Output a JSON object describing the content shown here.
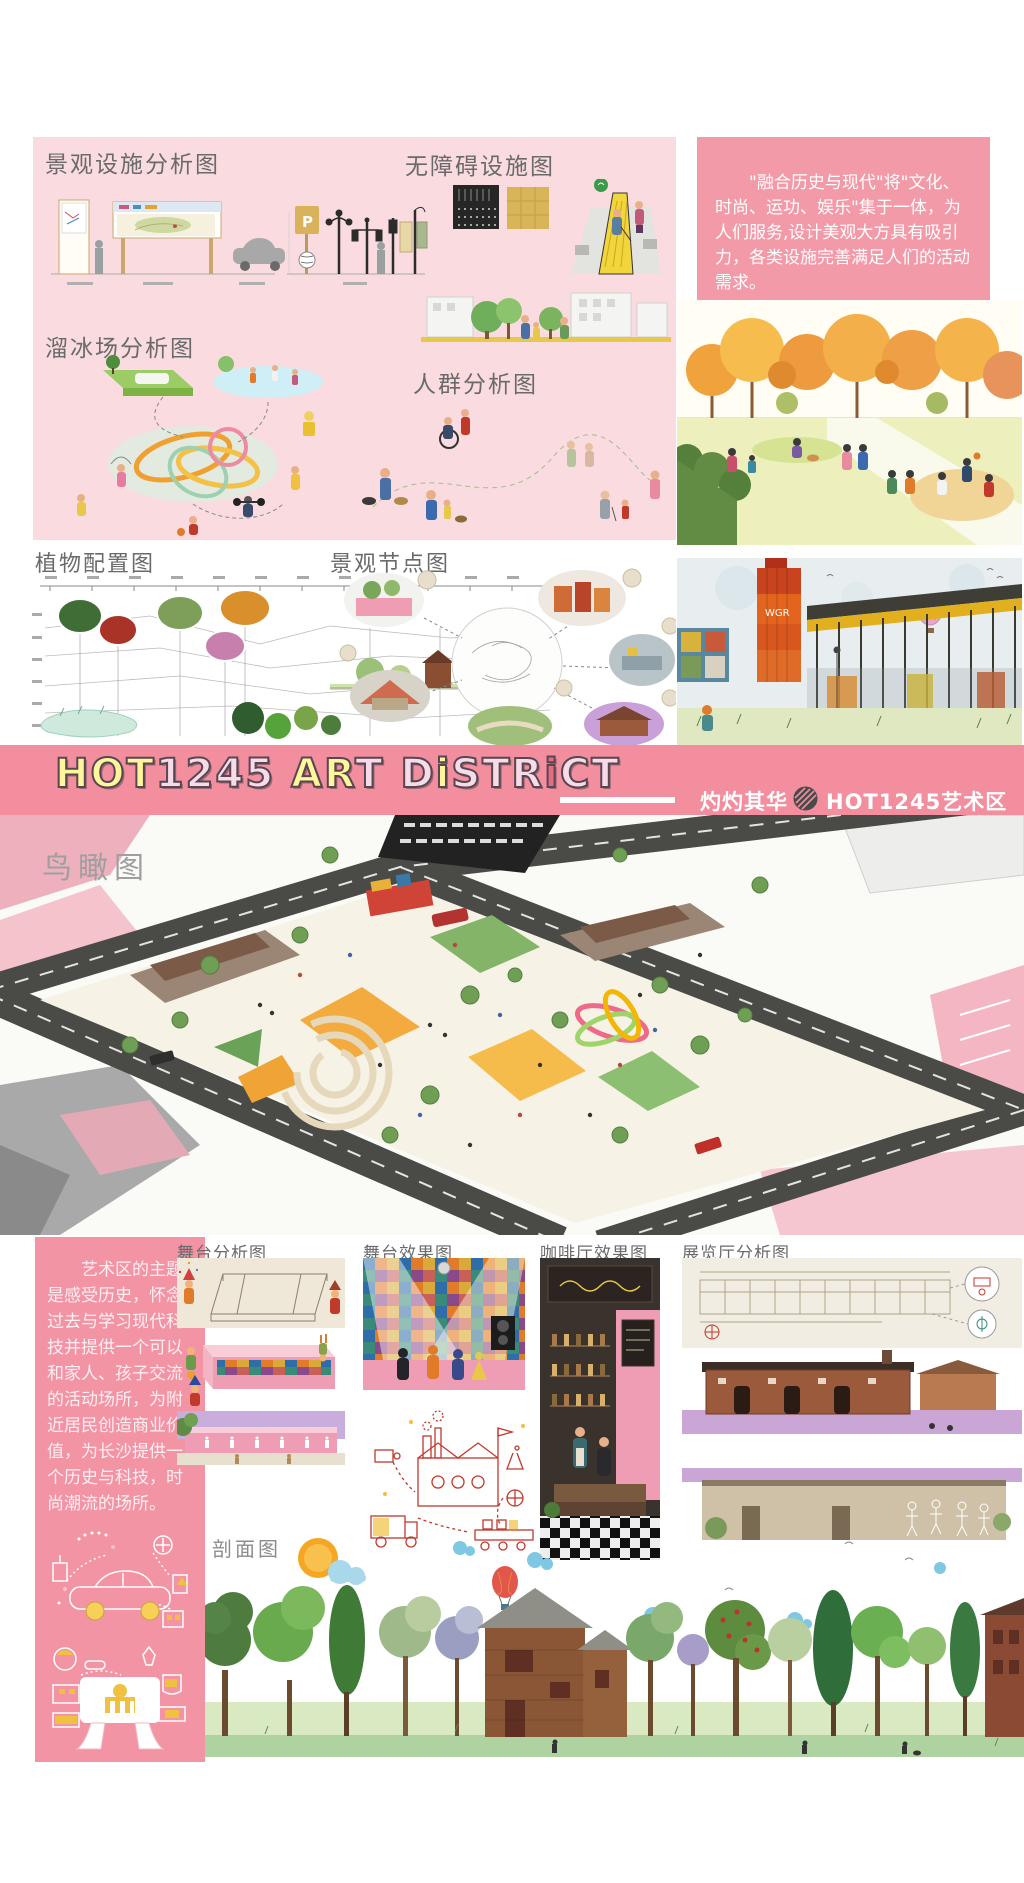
{
  "poster": {
    "width": 1024,
    "height": 1883
  },
  "colors": {
    "panel_pink": "#FADCE0",
    "intro_box_pink": "#F29AA8",
    "banner_pink": "#F28E9E",
    "sidebar_pink": "#F394A4",
    "title_gray": "#6A6A6A",
    "watermark_gray": "#9F9F9F",
    "letter_yellow": "#FFF59A",
    "letter_pale_pink": "#F8DBE8",
    "letter_accent_pink": "#E86A80"
  },
  "top_panel": {
    "landscape_facilities_title": "景观设施分析图",
    "barrier_free_title": "无障碍设施图",
    "ice_rink_title": "溜冰场分析图",
    "crowd_title": "人群分析图",
    "parking_sign_letter": "P",
    "intro_text": "\"融合历史与现代\"将\"文化、时尚、运功、娱乐\"集于一体，为人们服务,设计美观大方具有吸引力，各类设施完善满足人们的活动需求。"
  },
  "middle_row": {
    "plant_config_title": "植物配置图",
    "landscape_nodes_title": "景观节点图",
    "tower_sign_text": "WGR"
  },
  "banner": {
    "letters": [
      {
        "ch": "H",
        "color": "#FFF59A"
      },
      {
        "ch": "O",
        "color": "#FFF59A"
      },
      {
        "ch": "T",
        "color": "#FFF59A"
      },
      {
        "ch": "1",
        "color": "#F8DBE8"
      },
      {
        "ch": "2",
        "color": "#F8DBE8"
      },
      {
        "ch": "4",
        "color": "#F8DBE8"
      },
      {
        "ch": "5",
        "color": "#F8DBE8"
      },
      {
        "ch": " "
      },
      {
        "ch": "A",
        "color": "#FFF59A"
      },
      {
        "ch": "R",
        "color": "#FFF59A"
      },
      {
        "ch": "T",
        "color": "#F8DBE8"
      },
      {
        "ch": " "
      },
      {
        "ch": "D",
        "color": "#F8DBE8"
      },
      {
        "ch": "i",
        "color": "#FFF59A"
      },
      {
        "ch": "S",
        "color": "#F8DBE8"
      },
      {
        "ch": "T",
        "color": "#F8DBE8"
      },
      {
        "ch": "R",
        "color": "#F8DBE8"
      },
      {
        "ch": "i",
        "color": "#E86A80"
      },
      {
        "ch": "C",
        "color": "#F8DBE8"
      },
      {
        "ch": "T",
        "color": "#F8DBE8"
      }
    ],
    "tagline": "灼灼其华",
    "brand": "HOT1245艺术区"
  },
  "aerial": {
    "label": "鸟瞰图"
  },
  "bottom": {
    "sidebar_text": "艺术区的主题是感受历史，怀念过去与学习现代科技并提供一个可以和家人、孩子交流的活动场所，为附近居民创造商业价值，为长沙提供一个历史与科技，时尚潮流的场所。",
    "stage_analysis_title": "舞台分析图",
    "stage_render_title": "舞台效果图",
    "cafe_render_title": "咖啡厅效果图",
    "exhibition_title": "展览厅分析图",
    "section_title": "剖面图"
  }
}
